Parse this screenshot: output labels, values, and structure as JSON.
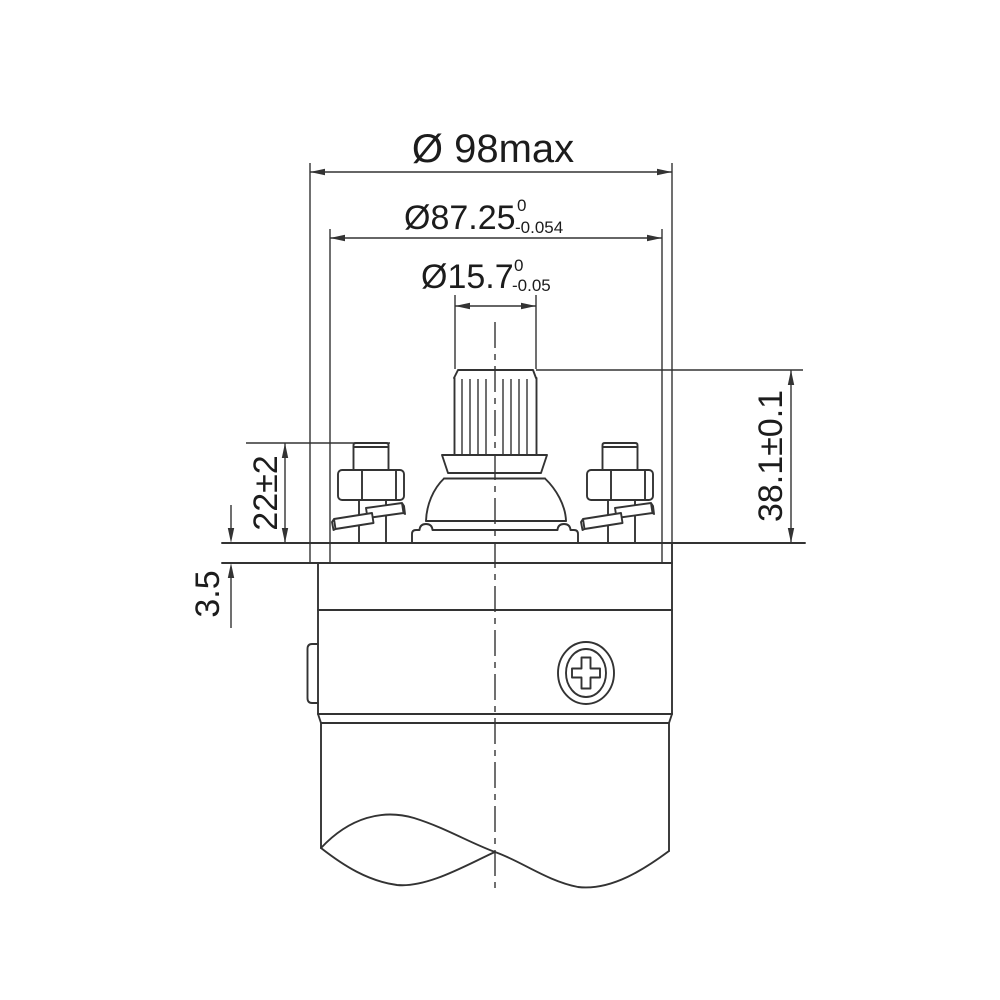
{
  "drawing": {
    "type": "engineering-dimension-drawing",
    "dimensions": {
      "outer_diameter": {
        "label": "Ø 98max"
      },
      "flange_diameter": {
        "label": "Ø87.25",
        "tol_upper": "0",
        "tol_lower": "-0.054"
      },
      "shaft_diameter": {
        "label": "Ø15.7",
        "tol_upper": "0",
        "tol_lower": "-0.05"
      },
      "shaft_height": {
        "label": "38.1±0.1"
      },
      "terminal_height": {
        "label": "22±2"
      },
      "plate_thickness": {
        "label": "3.5"
      }
    },
    "colors": {
      "line": "#333333",
      "text": "#1c1c1c",
      "background": "#ffffff"
    }
  }
}
